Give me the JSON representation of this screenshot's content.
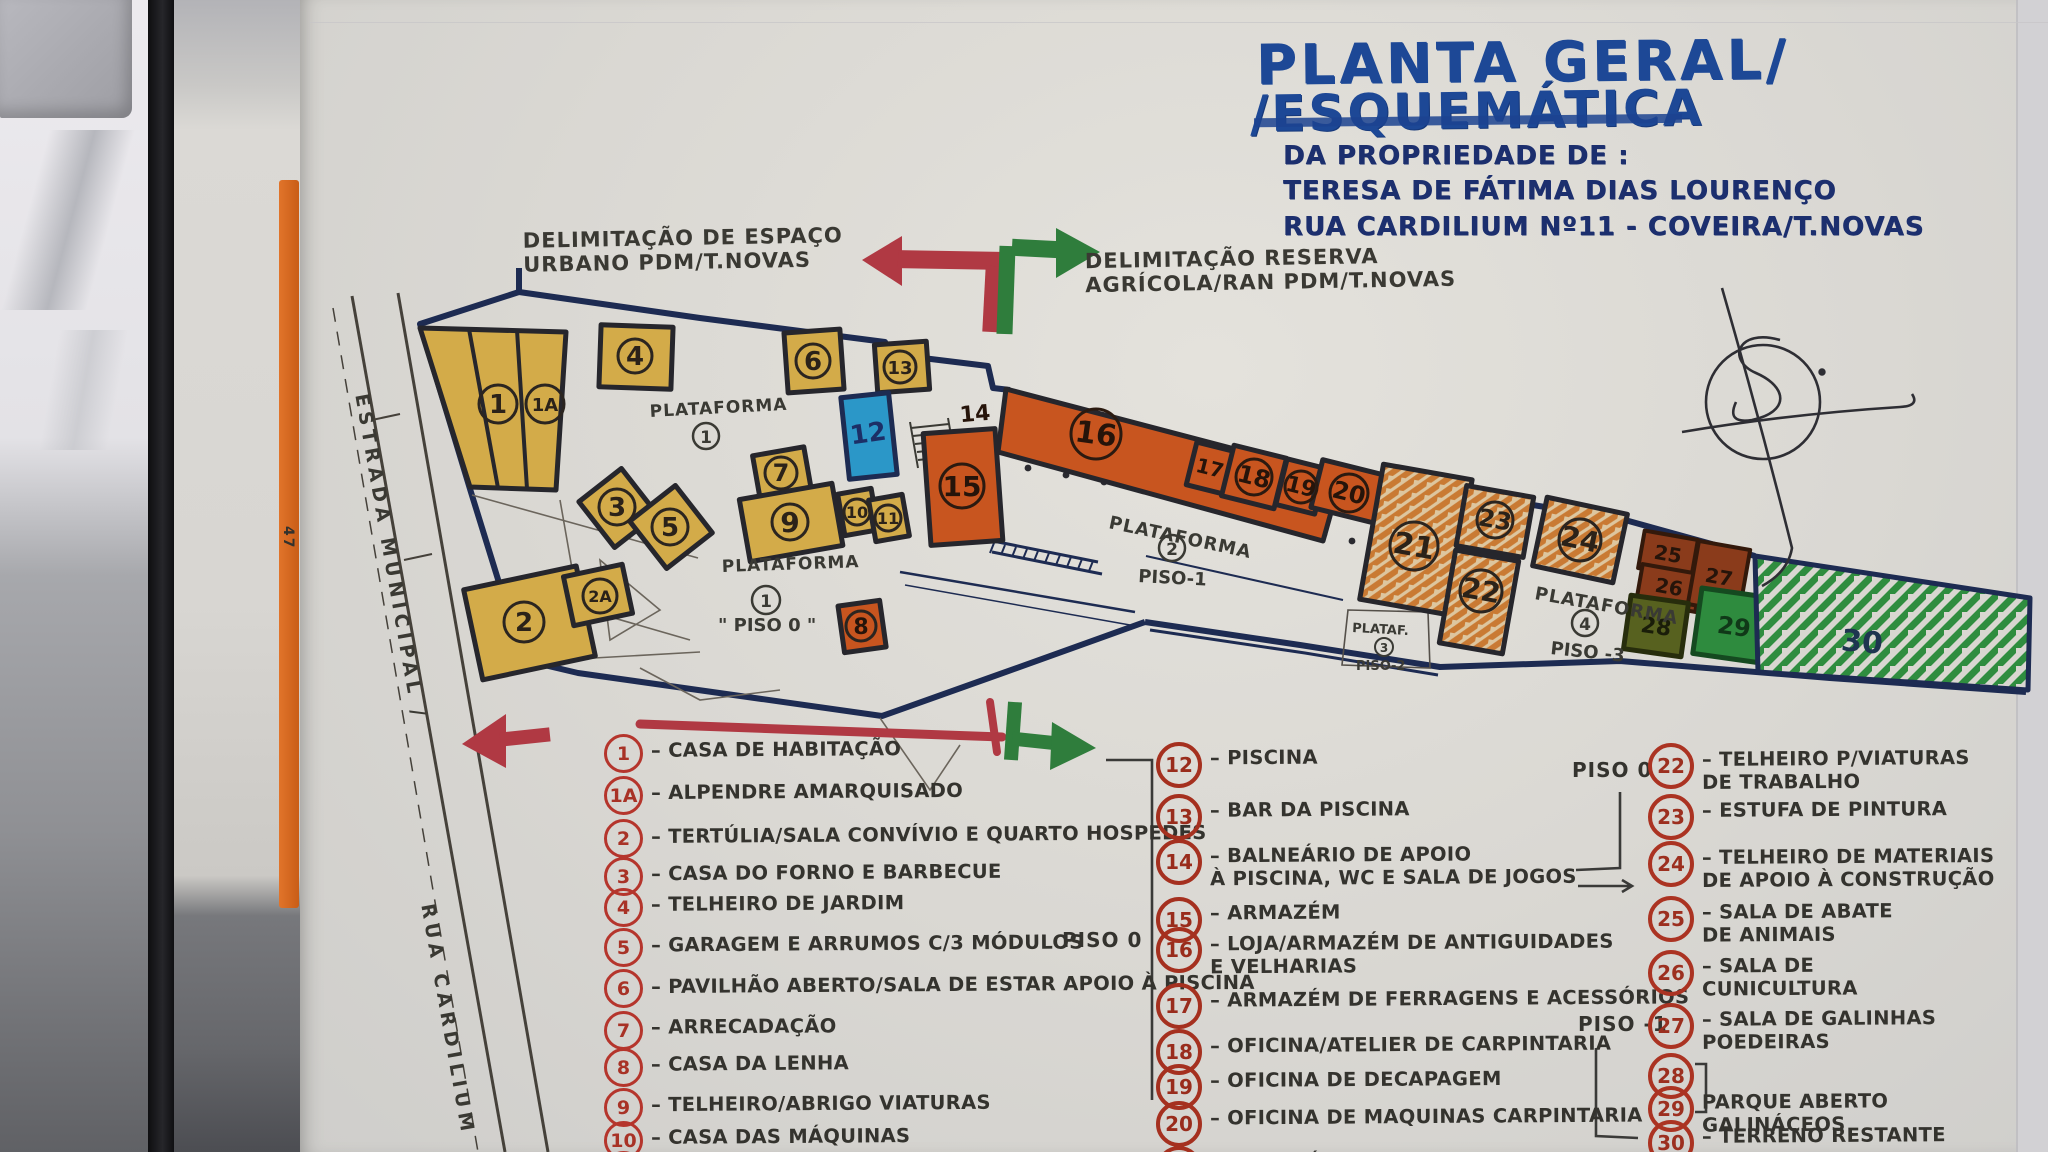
{
  "title_block": {
    "line1": "PLANTA GERAL/",
    "line2": "/ESQUEMÁTICA",
    "line3": "DA PROPRIEDADE DE :",
    "line4": "TERESA DE FÁTIMA DIAS LOURENÇO",
    "line5": "RUA CARDILIUM Nº11 - COVEIRA/T.NOVAS"
  },
  "annotations": {
    "urban_delim": "DELIMITAÇÃO DE ESPAÇO\nURBANO PDM/T.NOVAS",
    "agri_delim": "DELIMITAÇÃO RESERVA\nAGRÍCOLA/RAN PDM/T.NOVAS",
    "road_label_1": "ESTRADA MUNICIPAL /",
    "road_label_2": "RUA CARDILIUM",
    "side_marking": "47"
  },
  "plan": {
    "platform_labels": [
      {
        "name": "PLATAFORMA",
        "num": "1",
        "piso": ""
      },
      {
        "name": "PLATAFORMA",
        "num": "1",
        "piso": "\" PISO 0 \""
      },
      {
        "name": "PLATAFORMA",
        "num": "2",
        "piso": "PISO-1"
      },
      {
        "name": "PLATAF.",
        "num": "3",
        "piso": "PISO-2"
      },
      {
        "name": "PLATAFORMA",
        "num": "4",
        "piso": "PISO -3"
      }
    ],
    "buildings": [
      {
        "num": "1"
      },
      {
        "num": "1A"
      },
      {
        "num": "2"
      },
      {
        "num": "2A"
      },
      {
        "num": "3"
      },
      {
        "num": "4"
      },
      {
        "num": "5"
      },
      {
        "num": "6"
      },
      {
        "num": "7"
      },
      {
        "num": "8"
      },
      {
        "num": "9"
      },
      {
        "num": "10"
      },
      {
        "num": "11"
      },
      {
        "num": "12"
      },
      {
        "num": "13"
      },
      {
        "num": "14"
      },
      {
        "num": "15"
      },
      {
        "num": "16"
      },
      {
        "num": "17"
      },
      {
        "num": "18"
      },
      {
        "num": "19"
      },
      {
        "num": "20"
      },
      {
        "num": "21"
      },
      {
        "num": "22"
      },
      {
        "num": "23"
      },
      {
        "num": "24"
      },
      {
        "num": "25"
      },
      {
        "num": "26"
      },
      {
        "num": "27"
      },
      {
        "num": "28"
      },
      {
        "num": "29"
      },
      {
        "num": "30"
      }
    ]
  },
  "legend": {
    "piso0_mid": "PISO 0",
    "col3_piso0": "PISO 0",
    "col3_piso_minus1": "PISO -1",
    "col1": [
      {
        "num": "1",
        "label": "– CASA DE HABITAÇÃO"
      },
      {
        "num": "1A",
        "label": "– ALPENDRE AMARQUISADO"
      },
      {
        "num": "2",
        "label": "– TERTÚLIA/SALA CONVÍVIO E QUARTO HOSPEDES"
      },
      {
        "num": "3",
        "label": "– CASA DO FORNO E BARBECUE"
      },
      {
        "num": "4",
        "label": "– TELHEIRO DE JARDIM"
      },
      {
        "num": "5",
        "label": "– GARAGEM E ARRUMOS C/3 MÓDULOS"
      },
      {
        "num": "6",
        "label": "– PAVILHÃO ABERTO/SALA DE ESTAR APOIO À PISCINA"
      },
      {
        "num": "7",
        "label": "– ARRECADAÇÃO"
      },
      {
        "num": "8",
        "label": "– CASA DA LENHA"
      },
      {
        "num": "9",
        "label": "– TELHEIRO/ABRIGO VIATURAS"
      },
      {
        "num": "10",
        "label": "– CASA DAS MÁQUINAS"
      },
      {
        "num": "11",
        "label": ""
      }
    ],
    "col2": [
      {
        "num": "12",
        "label": "– PISCINA"
      },
      {
        "num": "13",
        "label": "– BAR DA PISCINA"
      },
      {
        "num": "14",
        "label": "– BALNEÁRIO DE APOIO\nÀ PISCINA, WC E SALA DE JOGOS"
      },
      {
        "num": "15",
        "label": "– ARMAZÉM"
      },
      {
        "num": "16",
        "label": "– LOJA/ARMAZÉM DE ANTIGUIDADES\nE VELHARIAS"
      },
      {
        "num": "17",
        "label": "– ARMAZÉM DE FERRAGENS E ACESSÓRIOS"
      },
      {
        "num": "18",
        "label": "– OFICINA/ATELIER DE CARPINTARIA"
      },
      {
        "num": "19",
        "label": "– OFICINA DE DECAPAGEM"
      },
      {
        "num": "20",
        "label": "– OFICINA DE MAQUINAS CARPINTARIA"
      },
      {
        "num": "21",
        "label": "– ARMAZÉM DE ESTALEIRO PISO-2"
      }
    ],
    "col3": [
      {
        "num": "22",
        "label": "– TELHEIRO P/VIATURAS\nDE TRABALHO"
      },
      {
        "num": "23",
        "label": "– ESTUFA DE PINTURA"
      },
      {
        "num": "24",
        "label": "– TELHEIRO DE MATERIAIS\nDE APOIO À CONSTRUÇÃO"
      },
      {
        "num": "25",
        "label": "– SALA DE ABATE\nDE ANIMAIS"
      },
      {
        "num": "26",
        "label": "– SALA DE\nCUNICULTURA"
      },
      {
        "num": "27",
        "label": "– SALA DE GALINHAS\nPOEDEIRAS"
      },
      {
        "num": "28",
        "label": ""
      },
      {
        "num": "29",
        "label": "PARQUE ABERTO\nGALINÁCEOS"
      },
      {
        "num": "30",
        "label": "– TERRENO RESTANTE"
      }
    ]
  },
  "colors": {
    "marker_blue": "#1d4896",
    "ink_navy": "#1c2f6e",
    "ink_black": "#33322d",
    "marker_red": "#b03943",
    "marker_green": "#2f7d3c",
    "legend_red": "#ab3322",
    "building_yellow": "#d3ab49",
    "building_orange": "#c8551f",
    "pool_blue": "#2b97c8",
    "boundary_navy": "#1d2b52",
    "brown": "#8a3b1b",
    "olive": "#57611f",
    "green": "#2e8b3e"
  }
}
